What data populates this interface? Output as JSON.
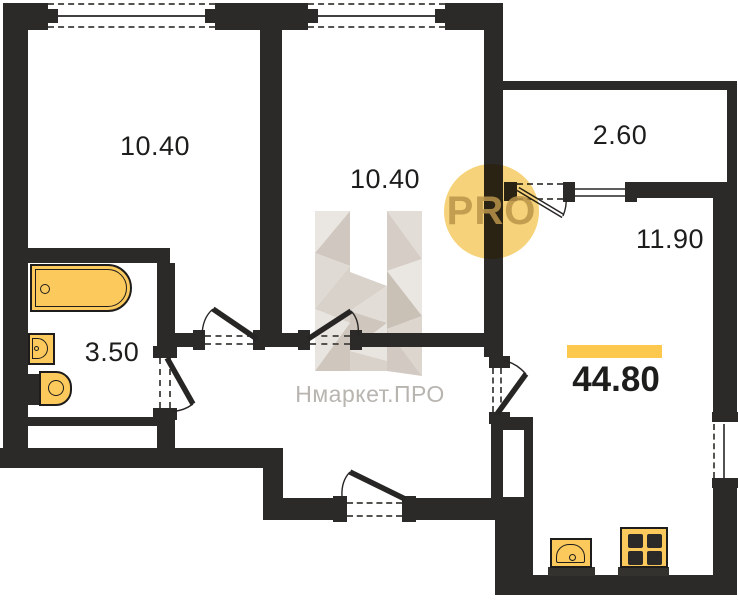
{
  "plan": {
    "rooms": [
      {
        "id": "bedroom-left",
        "area": "10.40"
      },
      {
        "id": "bedroom-middle",
        "area": "10.40"
      },
      {
        "id": "balcony",
        "area": "2.60"
      },
      {
        "id": "living-kitchen",
        "area": "11.90"
      },
      {
        "id": "bathroom",
        "area": "3.50"
      }
    ],
    "total_area": "44.80",
    "fixtures": [
      "bathtub",
      "washbasin",
      "toilet",
      "kitchen-sink",
      "stove",
      "ventilation-shaft"
    ],
    "openings": [
      "window",
      "balcony-door",
      "interior-door",
      "entrance-door"
    ]
  },
  "watermark": {
    "brand": "Нмаркет.ПРО",
    "badge": "PRO",
    "logo": "H-faceted-logo"
  },
  "colors": {
    "floor": "#ffffff",
    "wall": "#2b2a29",
    "fixture": "#fcc95d",
    "fixture_border": "#1e1d1b",
    "accent_bar": "#fcc84e",
    "pro_circle": "#f6d37a",
    "pro_text": "#ba944a",
    "watermark_text": "#b8b4b0",
    "label_text": "#1d1d1b"
  }
}
